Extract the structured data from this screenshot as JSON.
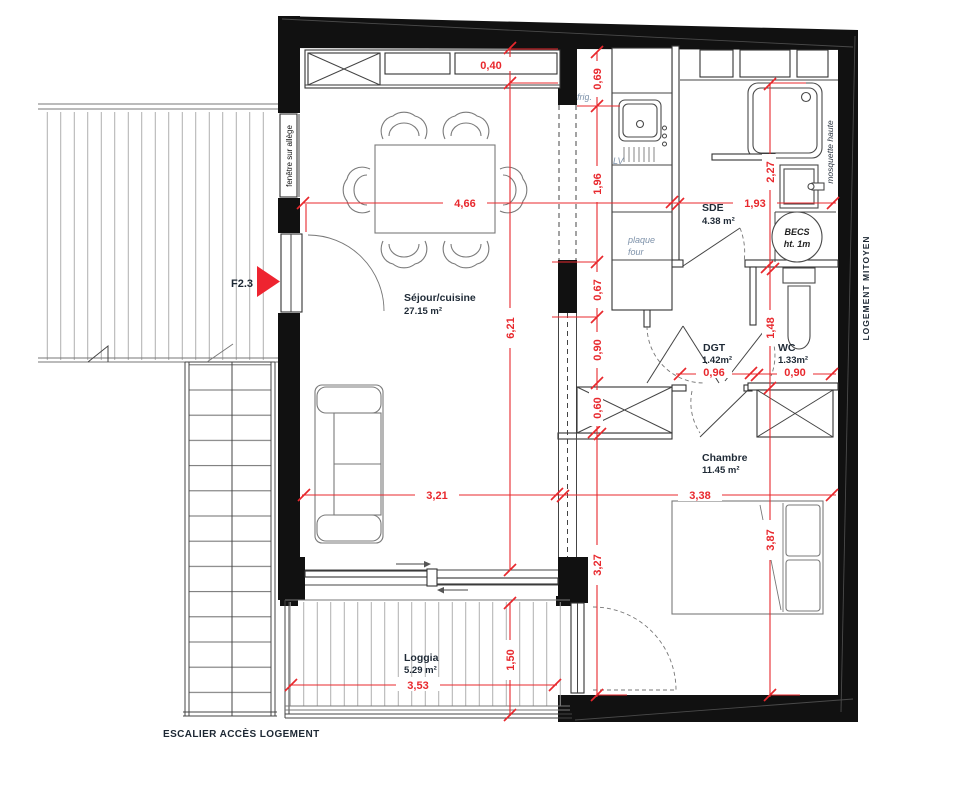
{
  "plan": {
    "rooms": {
      "sejour": {
        "name": "Séjour/cuisine",
        "area": "27.15 m²"
      },
      "sde": {
        "name": "SDE",
        "area": "4.38 m²"
      },
      "dgt": {
        "name": "DGT",
        "area": "1.42m²"
      },
      "wc": {
        "name": "WC",
        "area": "1.33m²"
      },
      "chambre": {
        "name": "Chambre",
        "area": "11.45 m²"
      },
      "loggia": {
        "name": "Loggia",
        "area": "5.29 m²"
      }
    },
    "annotations": {
      "fenetre": "fenêtre sur allège",
      "f23": "F2.3",
      "frig": "frig.",
      "lv": "LV",
      "plaque_l1": "plaque",
      "plaque_l2": "four",
      "becs_l1": "BECS",
      "becs_l2": "ht. 1m",
      "moustiquaire": "mosquette haute",
      "mitoyen": "LOGEMENT MITOYEN",
      "escalier": "ESCALIER ACCÈS LOGEMENT"
    },
    "dims": {
      "d040": "0,40",
      "d069": "0,69",
      "d196": "1,96",
      "d067": "0,67",
      "d090k": "0,90",
      "d060": "0,60",
      "d466": "4,66",
      "d193": "1,93",
      "d227": "2,27",
      "d148": "1,48",
      "d096": "0,96",
      "d090w": "0,90",
      "d621": "6,21",
      "d321": "3,21",
      "d338": "3,38",
      "d387": "3,87",
      "d327": "3,27",
      "d150": "1,50",
      "d353": "3,53"
    },
    "colors": {
      "dimension": "#e8282d",
      "wall": "#111111",
      "arrow": "#ee2430"
    }
  }
}
